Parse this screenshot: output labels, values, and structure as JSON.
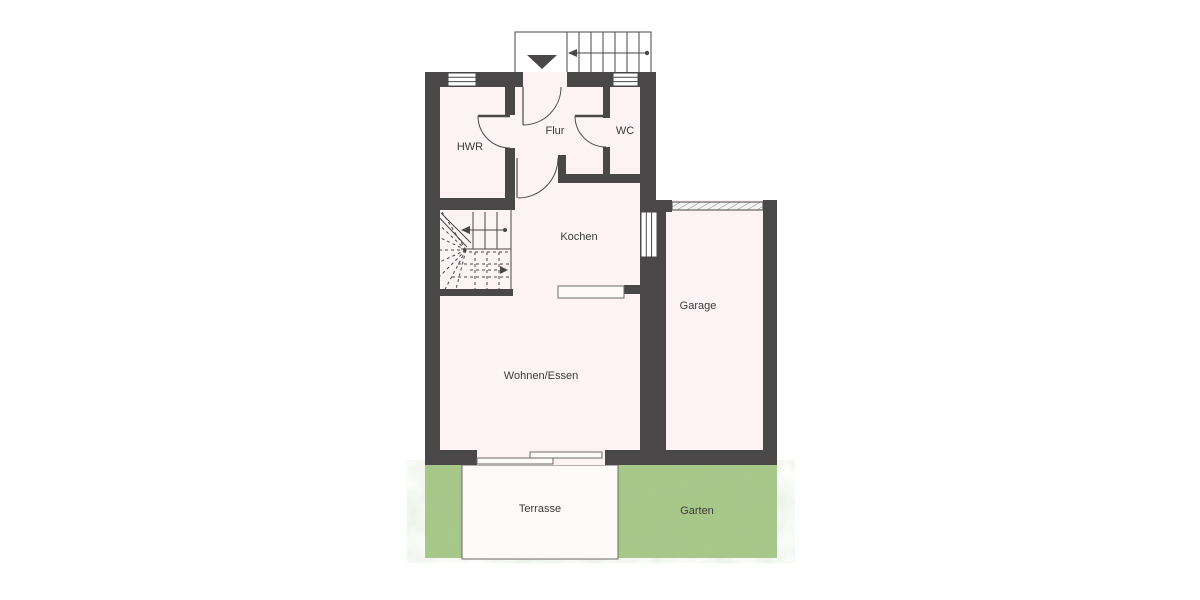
{
  "plan_type": "Erdgeschoss Grundriss",
  "rooms": {
    "hwr": "HWR",
    "flur": "Flur",
    "wc": "WC",
    "kochen": "Kochen",
    "garage": "Garage",
    "wohnen_essen": "Wohnen/Essen",
    "terrasse": "Terrasse",
    "garten": "Garten"
  },
  "colors": {
    "wall": "#4a4748",
    "interior": "#fdf3f4",
    "garden": "#a6c887",
    "garden_shade": "#8fb472",
    "terrace": "#fdf6f6",
    "line": "#4a4748",
    "label": "#3b3b3b",
    "background": "#ffffff"
  },
  "symbols": {
    "entrance_arrow": "down-triangle",
    "stair_direction_arrows": [
      "left",
      "right"
    ]
  }
}
